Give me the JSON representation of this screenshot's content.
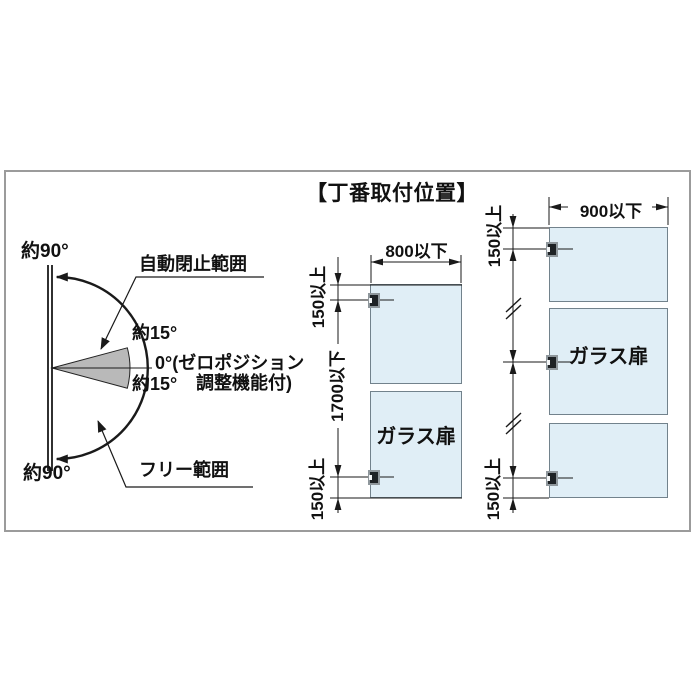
{
  "title": "【丁番取付位置】",
  "left_diagram": {
    "angle_top": "約90°",
    "angle_bottom": "約90°",
    "auto_close_label": "自動閉止範囲",
    "angle_15_upper": "約15°",
    "zero_position_line1": "0°(ゼロポジション",
    "zero_position_line2": "調整機能付)",
    "angle_15_lower": "約15°",
    "free_range_label": "フリー範囲"
  },
  "middle_door": {
    "width_max": "800以下",
    "top_hinge_offset": "150以上",
    "height_max": "1700以下",
    "bottom_hinge_offset": "150以上",
    "door_label": "ガラス扉",
    "hinge_count": 2
  },
  "right_door": {
    "width_max": "900以下",
    "top_hinge_offset": "150以上",
    "bottom_hinge_offset": "150以上",
    "door_label": "ガラス扉",
    "hinge_count": 3
  },
  "colors": {
    "door_fill": "#e0eef6",
    "wedge_fill": "#b9b9b9",
    "frame_border": "#9b9b9b",
    "line": "#1a1a1a"
  }
}
